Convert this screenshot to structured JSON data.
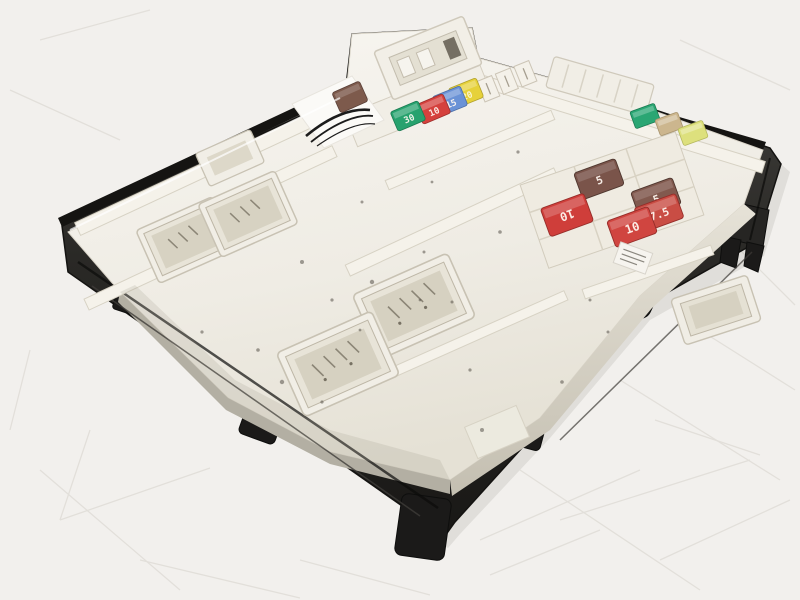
{
  "scene": {
    "type": "photograph",
    "subject": "Automotive fuse box body control module lying on a scratched light background"
  },
  "colors": {
    "background": "#f2f0ed",
    "housing_black": "#23211f",
    "tray_white": "#efece4",
    "tray_shadow": "#d8d4c8"
  },
  "fuses": {
    "cluster_top_center": [
      {
        "type": "mini-fuse",
        "color_name": "brown",
        "color": "#7d5a4c",
        "label": ""
      },
      {
        "type": "mini-fuse",
        "color_name": "green",
        "color": "#27a26e",
        "label": "30"
      },
      {
        "type": "mini-fuse",
        "color_name": "red",
        "color": "#d5413d",
        "label": "10"
      },
      {
        "type": "mini-fuse",
        "color_name": "blue",
        "color": "#6a92d6",
        "label": "15"
      },
      {
        "type": "mini-fuse",
        "color_name": "yellow",
        "color": "#e6d13a",
        "label": "20"
      }
    ],
    "cluster_top_right": [
      {
        "type": "mini-fuse",
        "color_name": "green",
        "color": "#2aa673",
        "label": ""
      },
      {
        "type": "mini-fuse",
        "color_name": "tan",
        "color": "#ccb68e",
        "label": ""
      },
      {
        "type": "mini-fuse",
        "color_name": "pale-yellow",
        "color": "#dde07d",
        "label": ""
      }
    ],
    "cluster_right": [
      {
        "type": "low-profile-fuse",
        "color_name": "brown",
        "color": "#7a544a",
        "label": "5"
      },
      {
        "type": "low-profile-fuse",
        "color_name": "brown",
        "color": "#81594e",
        "label": "5"
      },
      {
        "type": "low-profile-fuse",
        "color_name": "red",
        "color": "#cf3e3a",
        "label": "10"
      },
      {
        "type": "low-profile-fuse",
        "color_name": "red",
        "color": "#c94d44",
        "label": "7.5"
      },
      {
        "type": "low-profile-fuse",
        "color_name": "red",
        "color": "#d04540",
        "label": "10"
      }
    ]
  }
}
